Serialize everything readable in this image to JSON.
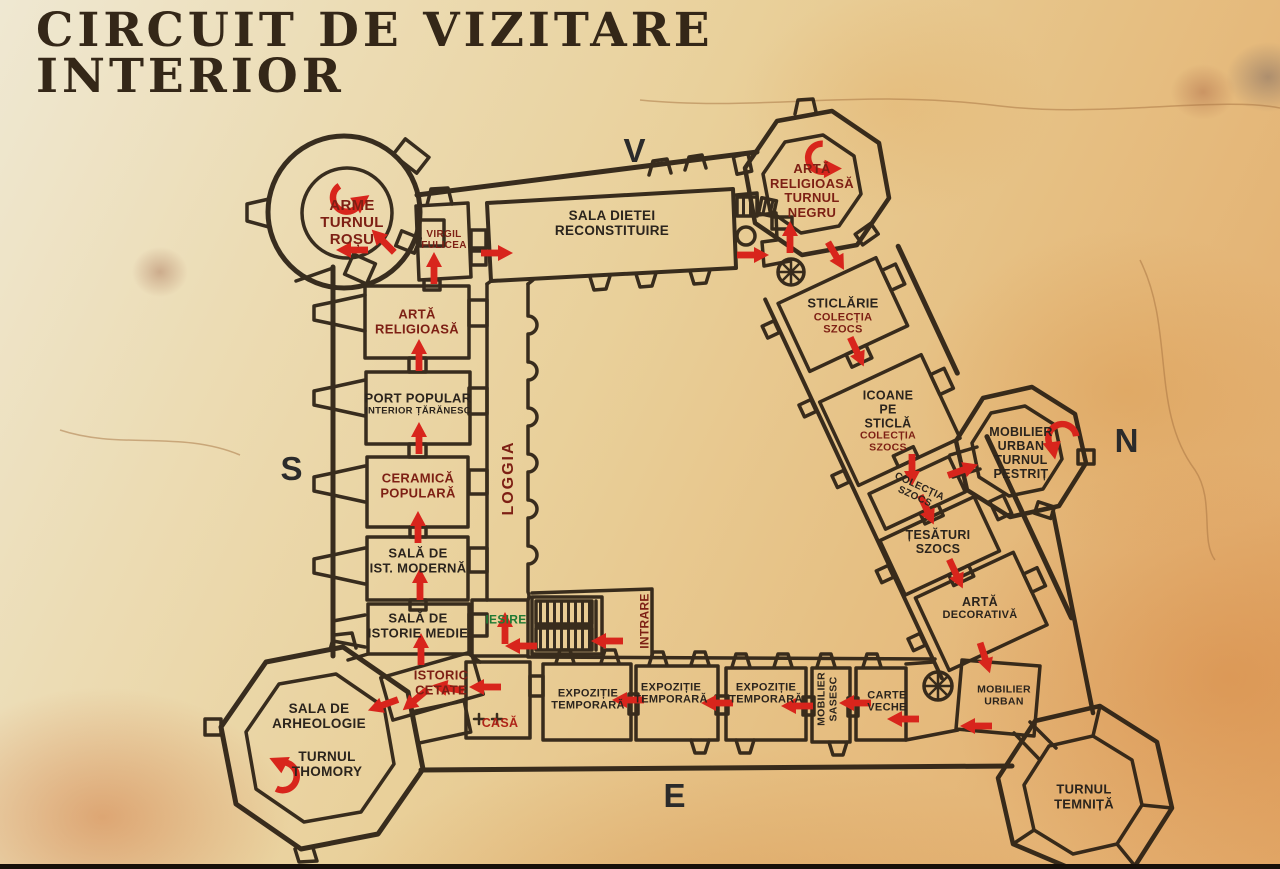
{
  "title": {
    "line1": "CIRCUIT DE VIZITARE",
    "line2": "INTERIOR"
  },
  "cardinal": {
    "west": "V",
    "north": "N",
    "south": "S",
    "east": "E"
  },
  "colors": {
    "d": "#2b241d",
    "m": "#7d1f14",
    "r": "#ae2317",
    "g": "#1e7a33",
    "arrow": "#d8251c",
    "wall": "#2a2014",
    "parchment": "#e8d3a0"
  },
  "labels": [
    {
      "id": "arme-turnul-rosu",
      "c": "m",
      "x": 352,
      "y": 223,
      "s": 15,
      "lines": [
        {
          "t": "ARME"
        },
        {
          "t": "TURNUL"
        },
        {
          "t": "ROȘU"
        }
      ]
    },
    {
      "id": "virgil-fulicea",
      "c": "m",
      "x": 444,
      "y": 240,
      "s": 10,
      "lines": [
        {
          "t": "VIRGIL"
        },
        {
          "t": "FULICEA"
        }
      ]
    },
    {
      "id": "sala-dietei",
      "c": "d",
      "x": 612,
      "y": 223,
      "s": 13.5,
      "lines": [
        {
          "t": "SALA DIETEI"
        },
        {
          "t": "RECONSTITUIRE"
        }
      ]
    },
    {
      "id": "arta-religioasa-turnul-negru",
      "c": "m",
      "x": 812,
      "y": 191,
      "s": 13,
      "lines": [
        {
          "t": "ARTĂ"
        },
        {
          "t": "RELIGIOASĂ"
        },
        {
          "t": "TURNUL"
        },
        {
          "t": "NEGRU"
        }
      ]
    },
    {
      "id": "sticlarie-colectia-szocs",
      "c": "d",
      "x": 843,
      "y": 316,
      "s": 13,
      "lines": [
        {
          "t": "STICLĂRIE"
        },
        {
          "t": "COLECȚIA",
          "c": "m",
          "s": 11
        },
        {
          "t": "SZOCS",
          "c": "m",
          "s": 11
        }
      ]
    },
    {
      "id": "icoane-pe-sticla",
      "c": "d",
      "x": 888,
      "y": 421,
      "s": 12.5,
      "lines": [
        {
          "t": "ICOANE"
        },
        {
          "t": "PE"
        },
        {
          "t": "STICLĂ"
        },
        {
          "t": "COLECȚIA",
          "c": "m",
          "s": 10.5
        },
        {
          "t": "SZOCS",
          "c": "m",
          "s": 10.5
        }
      ]
    },
    {
      "id": "colectia-szocs-room",
      "c": "d",
      "x": 917,
      "y": 492,
      "s": 10,
      "rot": 25,
      "lines": [
        {
          "t": "COLECȚIA"
        },
        {
          "t": "SZOCS"
        }
      ]
    },
    {
      "id": "tesaturi-szocs",
      "c": "d",
      "x": 938,
      "y": 542,
      "s": 12.5,
      "lines": [
        {
          "t": "ȚESĂTURI"
        },
        {
          "t": "SZOCS"
        }
      ]
    },
    {
      "id": "arta-decorativa",
      "c": "d",
      "x": 980,
      "y": 608,
      "s": 12.5,
      "lines": [
        {
          "t": "ARTĂ"
        },
        {
          "t": "DECORATIVĂ",
          "s": 11
        }
      ]
    },
    {
      "id": "mobilier-urban-turnul-pestrit",
      "c": "d",
      "x": 1021,
      "y": 453,
      "s": 12.5,
      "lines": [
        {
          "t": "MOBILIER"
        },
        {
          "t": "URBAN"
        },
        {
          "t": "TURNUL"
        },
        {
          "t": "PESTRIȚ"
        }
      ]
    },
    {
      "id": "arta-religioasa-sud",
      "c": "m",
      "x": 417,
      "y": 322,
      "s": 13,
      "lines": [
        {
          "t": "ARTĂ"
        },
        {
          "t": "RELIGIOASĂ"
        }
      ]
    },
    {
      "id": "port-popular",
      "c": "d",
      "x": 418,
      "y": 404,
      "s": 13,
      "lines": [
        {
          "t": "PORT POPULAR"
        },
        {
          "t": "INTERIOR ȚĂRĂNESC",
          "s": 9.5
        }
      ]
    },
    {
      "id": "ceramica-populara",
      "c": "m",
      "x": 418,
      "y": 486,
      "s": 13,
      "lines": [
        {
          "t": "CERAMICĂ"
        },
        {
          "t": "POPULARĂ"
        }
      ]
    },
    {
      "id": "sala-ist-moderna",
      "c": "d",
      "x": 418,
      "y": 561,
      "s": 13,
      "lines": [
        {
          "t": "SALĂ DE"
        },
        {
          "t": "IST. MODERNĂ"
        }
      ]
    },
    {
      "id": "sala-istorie-medie",
      "c": "d",
      "x": 418,
      "y": 626,
      "s": 13,
      "lines": [
        {
          "t": "SALĂ DE"
        },
        {
          "t": "ISTORIE MEDIE"
        }
      ]
    },
    {
      "id": "istoric-cetate",
      "c": "m",
      "x": 441,
      "y": 683,
      "s": 13,
      "lines": [
        {
          "t": "ISTORIC"
        },
        {
          "t": "CETATE"
        }
      ]
    },
    {
      "id": "iesire",
      "c": "g",
      "x": 506,
      "y": 620,
      "s": 12,
      "lines": [
        {
          "t": "IESIRE"
        }
      ]
    },
    {
      "id": "casa",
      "c": "r",
      "x": 500,
      "y": 723,
      "s": 12.5,
      "lines": [
        {
          "t": "CASĂ"
        }
      ]
    },
    {
      "id": "intrare",
      "c": "m",
      "x": 645,
      "y": 621,
      "s": 12,
      "rot": -90,
      "lines": [
        {
          "t": "INTRARE"
        }
      ]
    },
    {
      "id": "loggia",
      "c": "m",
      "x": 509,
      "y": 478,
      "s": 16,
      "rot": -90,
      "ls": 2,
      "lines": [
        {
          "t": "LOGGIA"
        }
      ]
    },
    {
      "id": "sala-de-arheologie",
      "c": "d",
      "x": 319,
      "y": 716,
      "s": 13.5,
      "lines": [
        {
          "t": "SALA DE"
        },
        {
          "t": "ARHEOLOGIE"
        }
      ]
    },
    {
      "id": "turnul-thomory",
      "c": "d",
      "x": 327,
      "y": 764,
      "s": 13.5,
      "lines": [
        {
          "t": "TURNUL"
        },
        {
          "t": "THOMORY"
        }
      ]
    },
    {
      "id": "expozitie-temporara-1",
      "c": "d",
      "x": 588,
      "y": 700,
      "s": 11,
      "lines": [
        {
          "t": "EXPOZIȚIE"
        },
        {
          "t": "TEMPORARĂ"
        }
      ]
    },
    {
      "id": "expozitie-temporara-2",
      "c": "d",
      "x": 671,
      "y": 694,
      "s": 11,
      "lines": [
        {
          "t": "EXPOZIȚIE"
        },
        {
          "t": "TEMPORARĂ"
        }
      ]
    },
    {
      "id": "expozitie-temporara-3",
      "c": "d",
      "x": 766,
      "y": 694,
      "s": 11,
      "lines": [
        {
          "t": "EXPOZIȚIE"
        },
        {
          "t": "TEMPORARĂ"
        }
      ]
    },
    {
      "id": "mobilier-sasesc",
      "c": "d",
      "x": 828,
      "y": 699,
      "s": 10.5,
      "rot": -90,
      "lines": [
        {
          "t": "MOBILIER"
        },
        {
          "t": "SASESC"
        }
      ]
    },
    {
      "id": "carte-veche",
      "c": "d",
      "x": 887,
      "y": 702,
      "s": 11,
      "lines": [
        {
          "t": "CARTE"
        },
        {
          "t": "VECHE"
        }
      ]
    },
    {
      "id": "mobilier-urban-est",
      "c": "d",
      "x": 1004,
      "y": 696,
      "s": 10.5,
      "lines": [
        {
          "t": "MOBILIER"
        },
        {
          "t": "URBAN"
        }
      ]
    },
    {
      "id": "turnul-temnita",
      "c": "d",
      "x": 1084,
      "y": 797,
      "s": 13,
      "lines": [
        {
          "t": "TURNUL"
        },
        {
          "t": "TEMNIȚĂ"
        }
      ]
    }
  ],
  "arrows": [
    {
      "x": 497,
      "y": 253,
      "a": 0
    },
    {
      "x": 753,
      "y": 255,
      "a": 0
    },
    {
      "x": 434,
      "y": 268,
      "a": -90
    },
    {
      "x": 352,
      "y": 250,
      "a": 180
    },
    {
      "x": 383,
      "y": 241,
      "a": -135
    },
    {
      "x": 790,
      "y": 237,
      "a": -90
    },
    {
      "x": 836,
      "y": 256,
      "a": 60
    },
    {
      "x": 857,
      "y": 352,
      "a": 65
    },
    {
      "x": 912,
      "y": 470,
      "a": 90
    },
    {
      "x": 927,
      "y": 510,
      "a": 65
    },
    {
      "x": 963,
      "y": 470,
      "a": -20
    },
    {
      "x": 956,
      "y": 574,
      "a": 65
    },
    {
      "x": 985,
      "y": 658,
      "a": 72
    },
    {
      "x": 976,
      "y": 726,
      "a": 180
    },
    {
      "x": 903,
      "y": 719,
      "a": 180
    },
    {
      "x": 855,
      "y": 703,
      "a": 180
    },
    {
      "x": 797,
      "y": 706,
      "a": 180
    },
    {
      "x": 717,
      "y": 703,
      "a": 180
    },
    {
      "x": 628,
      "y": 700,
      "a": 180
    },
    {
      "x": 485,
      "y": 687,
      "a": 180
    },
    {
      "x": 505,
      "y": 628,
      "a": -90
    },
    {
      "x": 521,
      "y": 646,
      "a": 180
    },
    {
      "x": 607,
      "y": 641,
      "a": 180
    },
    {
      "x": 419,
      "y": 355,
      "a": -90
    },
    {
      "x": 419,
      "y": 438,
      "a": -90
    },
    {
      "x": 418,
      "y": 527,
      "a": -90
    },
    {
      "x": 420,
      "y": 584,
      "a": -90
    },
    {
      "x": 421,
      "y": 649,
      "a": -90
    },
    {
      "x": 448,
      "y": 688,
      "a": -170
    },
    {
      "x": 415,
      "y": 700,
      "a": 140
    },
    {
      "x": 383,
      "y": 705,
      "a": 160
    },
    {
      "x": 347,
      "y": 198,
      "a": -20,
      "k": "c"
    },
    {
      "x": 822,
      "y": 158,
      "a": 15,
      "k": "c"
    },
    {
      "x": 1062,
      "y": 438,
      "a": 95,
      "k": "c"
    },
    {
      "x": 283,
      "y": 776,
      "a": -140,
      "k": "c"
    }
  ]
}
